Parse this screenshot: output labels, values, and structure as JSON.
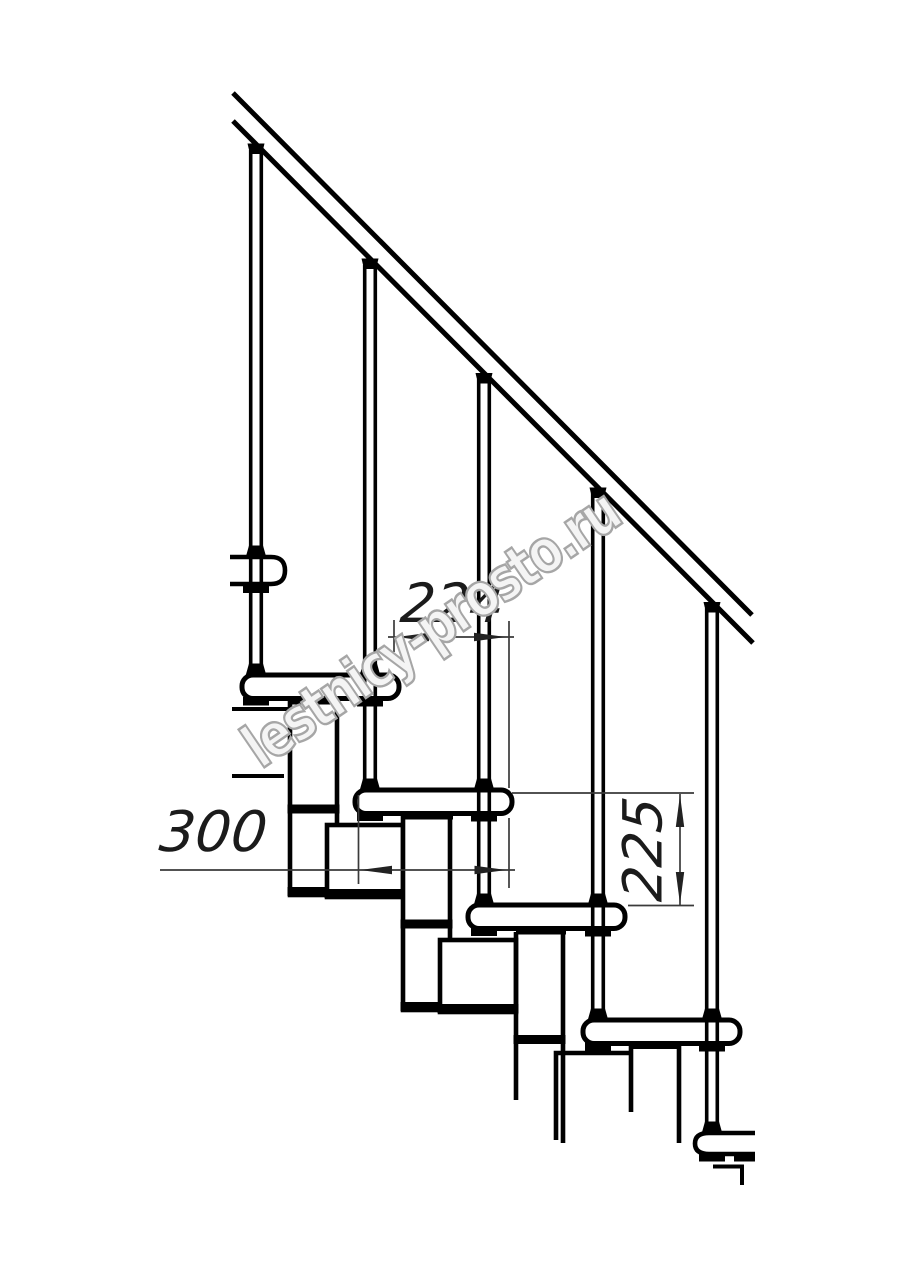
{
  "drawing": {
    "type": "staircase-side-view-technical-drawing"
  },
  "dimensions": {
    "d224": {
      "label": "224",
      "orientation": "horizontal"
    },
    "d300": {
      "label": "300",
      "orientation": "horizontal"
    },
    "d225": {
      "label": "225",
      "orientation": "vertical"
    }
  },
  "watermark": {
    "text": "lestnicy-prosto.ru"
  },
  "colors": {
    "line": "#000000",
    "thin_line": "#3a3a3a",
    "dimension_text": "#1b1b1b",
    "watermark_outline": "#a6a6a6",
    "background": "#ffffff"
  }
}
